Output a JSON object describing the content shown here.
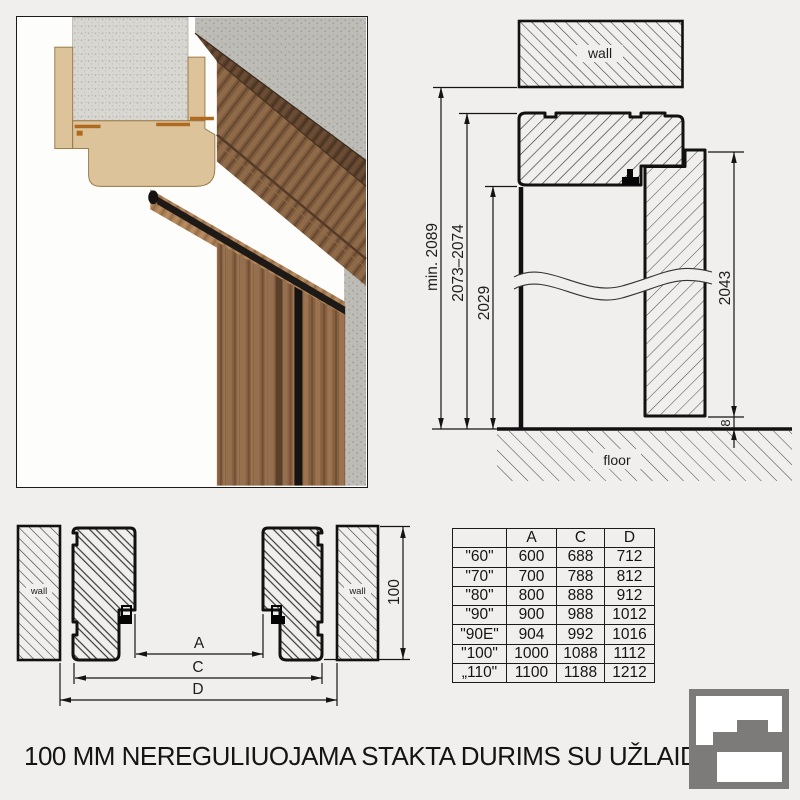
{
  "title": "100 MM NEREGULIUOJAMA STAKTA DURIMS SU UŽLAIDA",
  "elevation": {
    "wall_label": "wall",
    "floor_label": "floor",
    "dims": {
      "total": "min. 2089",
      "frame": "2073–2074",
      "opening": "2029",
      "door": "2043",
      "gap": "8"
    }
  },
  "section": {
    "wall_left_label": "wall",
    "wall_right_label": "wall",
    "dims": {
      "a": "A",
      "c": "C",
      "d": "D",
      "depth": "100"
    }
  },
  "table": {
    "headers": [
      "",
      "A",
      "C",
      "D"
    ],
    "rows": [
      {
        "cells": [
          "\"60\"",
          "600",
          "688",
          "712"
        ]
      },
      {
        "cells": [
          "\"70\"",
          "700",
          "788",
          "812"
        ]
      },
      {
        "cells": [
          "\"80\"",
          "800",
          "888",
          "912"
        ]
      },
      {
        "cells": [
          "\"90\"",
          "900",
          "988",
          "1012"
        ]
      },
      {
        "cells": [
          "\"90E\"",
          "904",
          "992",
          "1016"
        ]
      },
      {
        "cells": [
          "\"100\"",
          "1000",
          "1088",
          "1112"
        ]
      },
      {
        "cells": [
          "„110\"",
          "1100",
          "1188",
          "1212"
        ]
      }
    ]
  }
}
